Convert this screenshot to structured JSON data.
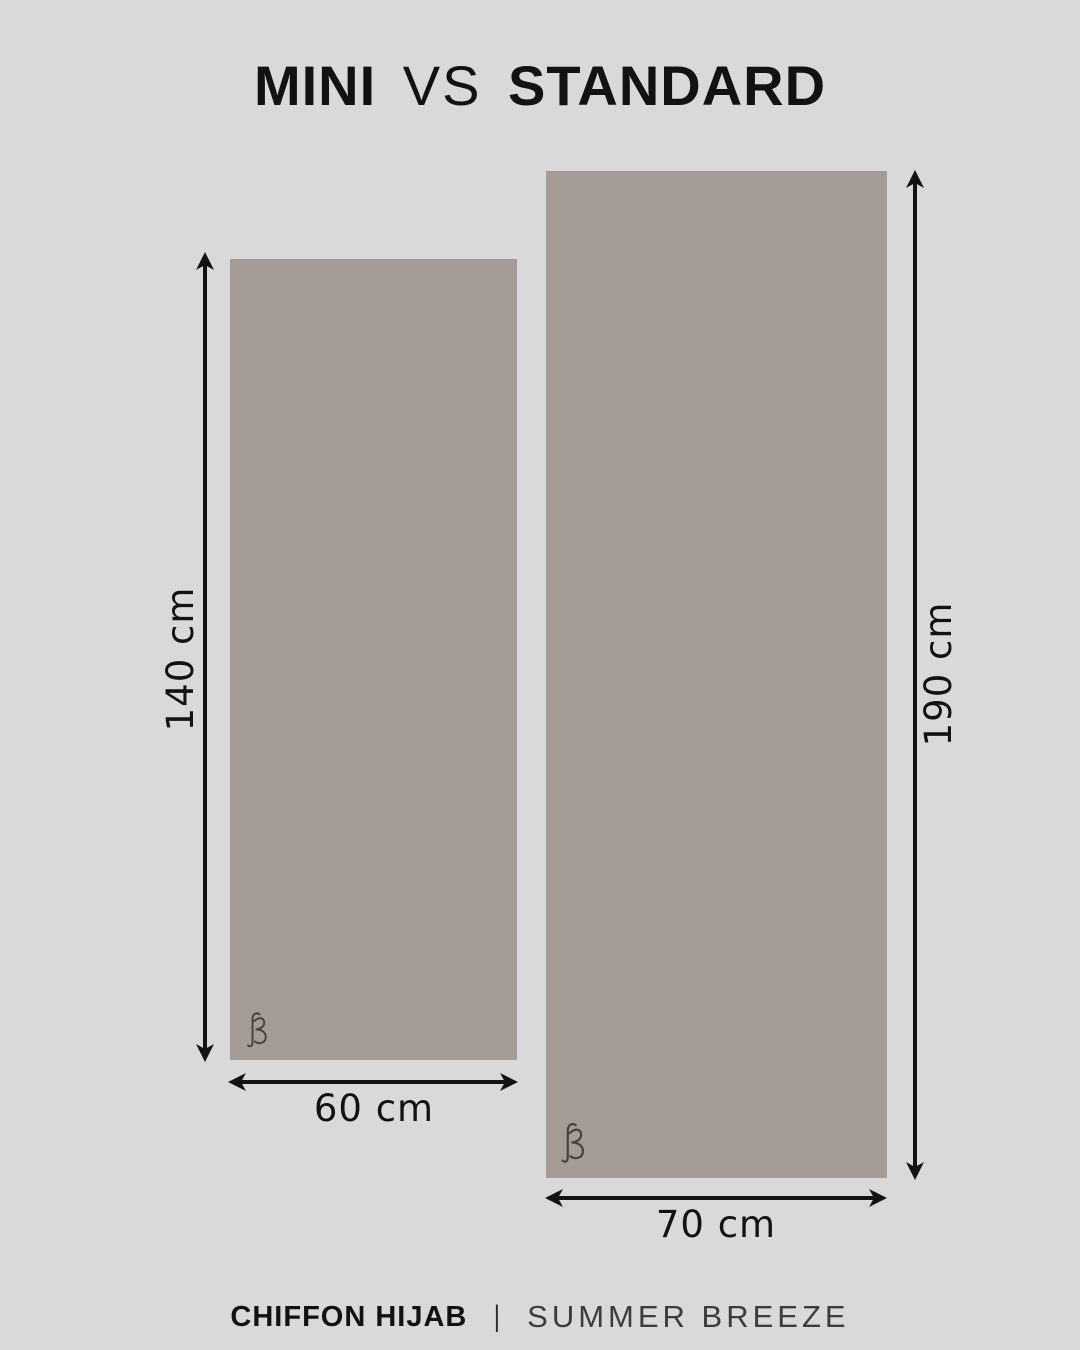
{
  "title": {
    "mini": "MINI",
    "vs": "VS",
    "standard": "STANDARD"
  },
  "panels": [
    {
      "id": "mini",
      "height_label": "140 cm",
      "width_label": "60 cm"
    },
    {
      "id": "standard",
      "height_label": "190 cm",
      "width_label": "70 cm"
    }
  ],
  "footer": {
    "product": "CHIFFON HIJAB",
    "separator": "|",
    "variant": "SUMMER BREEZE"
  },
  "colors": {
    "background": "#d9d9d9",
    "swatch": "#a49a96",
    "ink": "#121212",
    "logo": "#45403d",
    "variant_text": "#3c3c3c"
  },
  "icons": {
    "brand_monogram": "ß",
    "dimension_arrow": "double-headed-arrow"
  }
}
